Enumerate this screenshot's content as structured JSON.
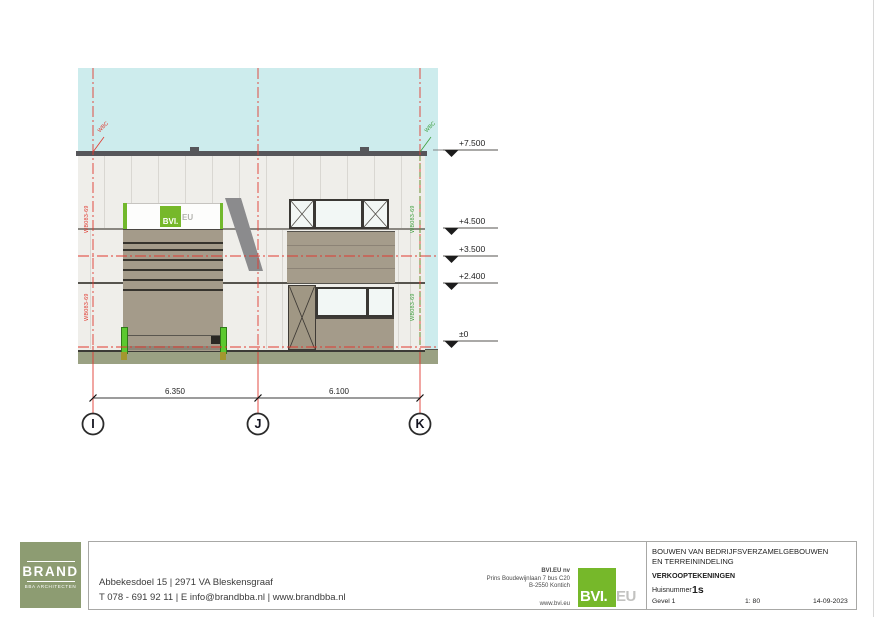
{
  "drawing": {
    "levels": [
      {
        "label": "+7.500"
      },
      {
        "label": "+4.500"
      },
      {
        "label": "+3.500"
      },
      {
        "label": "+2.400"
      },
      {
        "label": "±0"
      }
    ],
    "grid": {
      "i": "I",
      "j": "J",
      "k": "K",
      "dim_ij": "6.350",
      "dim_jk": "6.100"
    },
    "tags": {
      "wbc": "WBC",
      "wall_code": "WB083-69"
    },
    "sign": {
      "bvi": "BVI.",
      "eu": "EU"
    }
  },
  "titleblock": {
    "brand": {
      "name": "BRAND",
      "sub": "BBA ARCHITECTEN"
    },
    "address_line1": "Abbekesdoel 15 | 2971 VA Bleskensgraaf",
    "address_line2": "T 078 - 691 92 11 | E  info@brandbba.nl | www.brandbba.nl",
    "bvi": {
      "name": "BVI.EU nv",
      "addr1": "Prins Boudewijnlaan 7 bus C20",
      "addr2": "B-2550 Kontich",
      "web": "www.bvi.eu",
      "logo_bvi": "BVI.",
      "logo_eu": "EU"
    },
    "project": {
      "title1": "BOUWEN VAN BEDRIJFSVERZAMELGEBOUWEN",
      "title2": "EN TERREININDELING",
      "doc_type": "VERKOOPTEKENINGEN",
      "huisnummer_label": "Huisnummer",
      "huisnummer": "1s",
      "sheet": "Gevel 1",
      "scale": "1: 80",
      "date": "14-09-2023"
    }
  },
  "colors": {
    "sky": "#cdeced",
    "wall": "#efeeea",
    "cladding_taupe": "#a49b8a",
    "ground": "#9aa183",
    "grid_red": "#e03a30",
    "tag_green": "#3c9e3c",
    "bvi_green": "#76b82a",
    "bollard_green": "#5bc92f",
    "brand_olive": "#8d9c72"
  }
}
